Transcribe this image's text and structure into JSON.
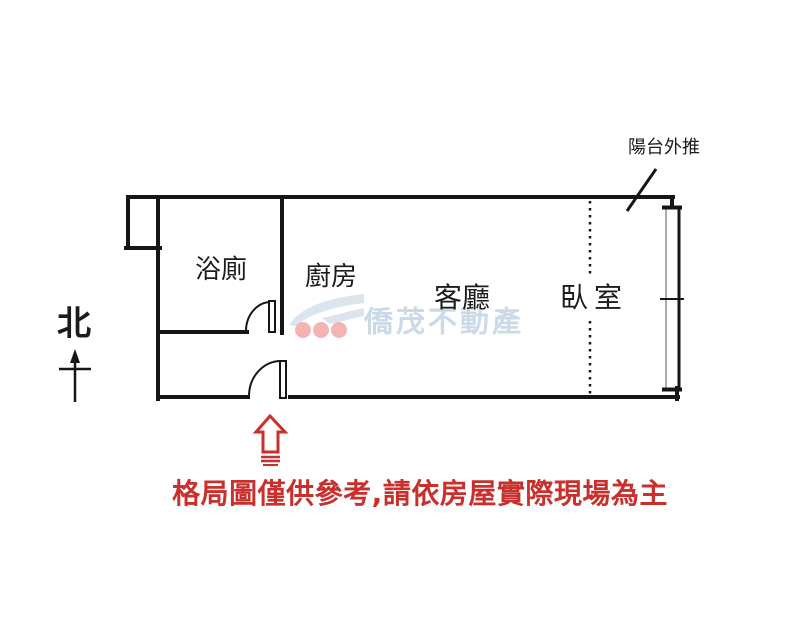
{
  "floorplan": {
    "rooms": [
      {
        "name": "bathroom",
        "label": "浴廁"
      },
      {
        "name": "kitchen",
        "label": "廚房"
      },
      {
        "name": "living-room",
        "label": "客廳"
      },
      {
        "name": "bedroom",
        "label": "臥室"
      }
    ],
    "balcony_note": "陽台外推",
    "compass_label": "北",
    "symbols": [
      "north-arrow",
      "entrance-arrow",
      "bathroom-door-swing",
      "entrance-door-swing",
      "window",
      "dashed-partition"
    ]
  },
  "watermark": {
    "brand": "僑茂不動產"
  },
  "disclaimer": {
    "text": "格局圖僅供參考,請依房屋實際現場為主"
  },
  "colors": {
    "wall": "#161616",
    "accent_red": "#c9302c",
    "watermark_text": "#ccd9e8",
    "watermark_shape": "#dce4ee",
    "watermark_dots": "#f2b5b2",
    "window_inner": "#8f8f8f"
  }
}
